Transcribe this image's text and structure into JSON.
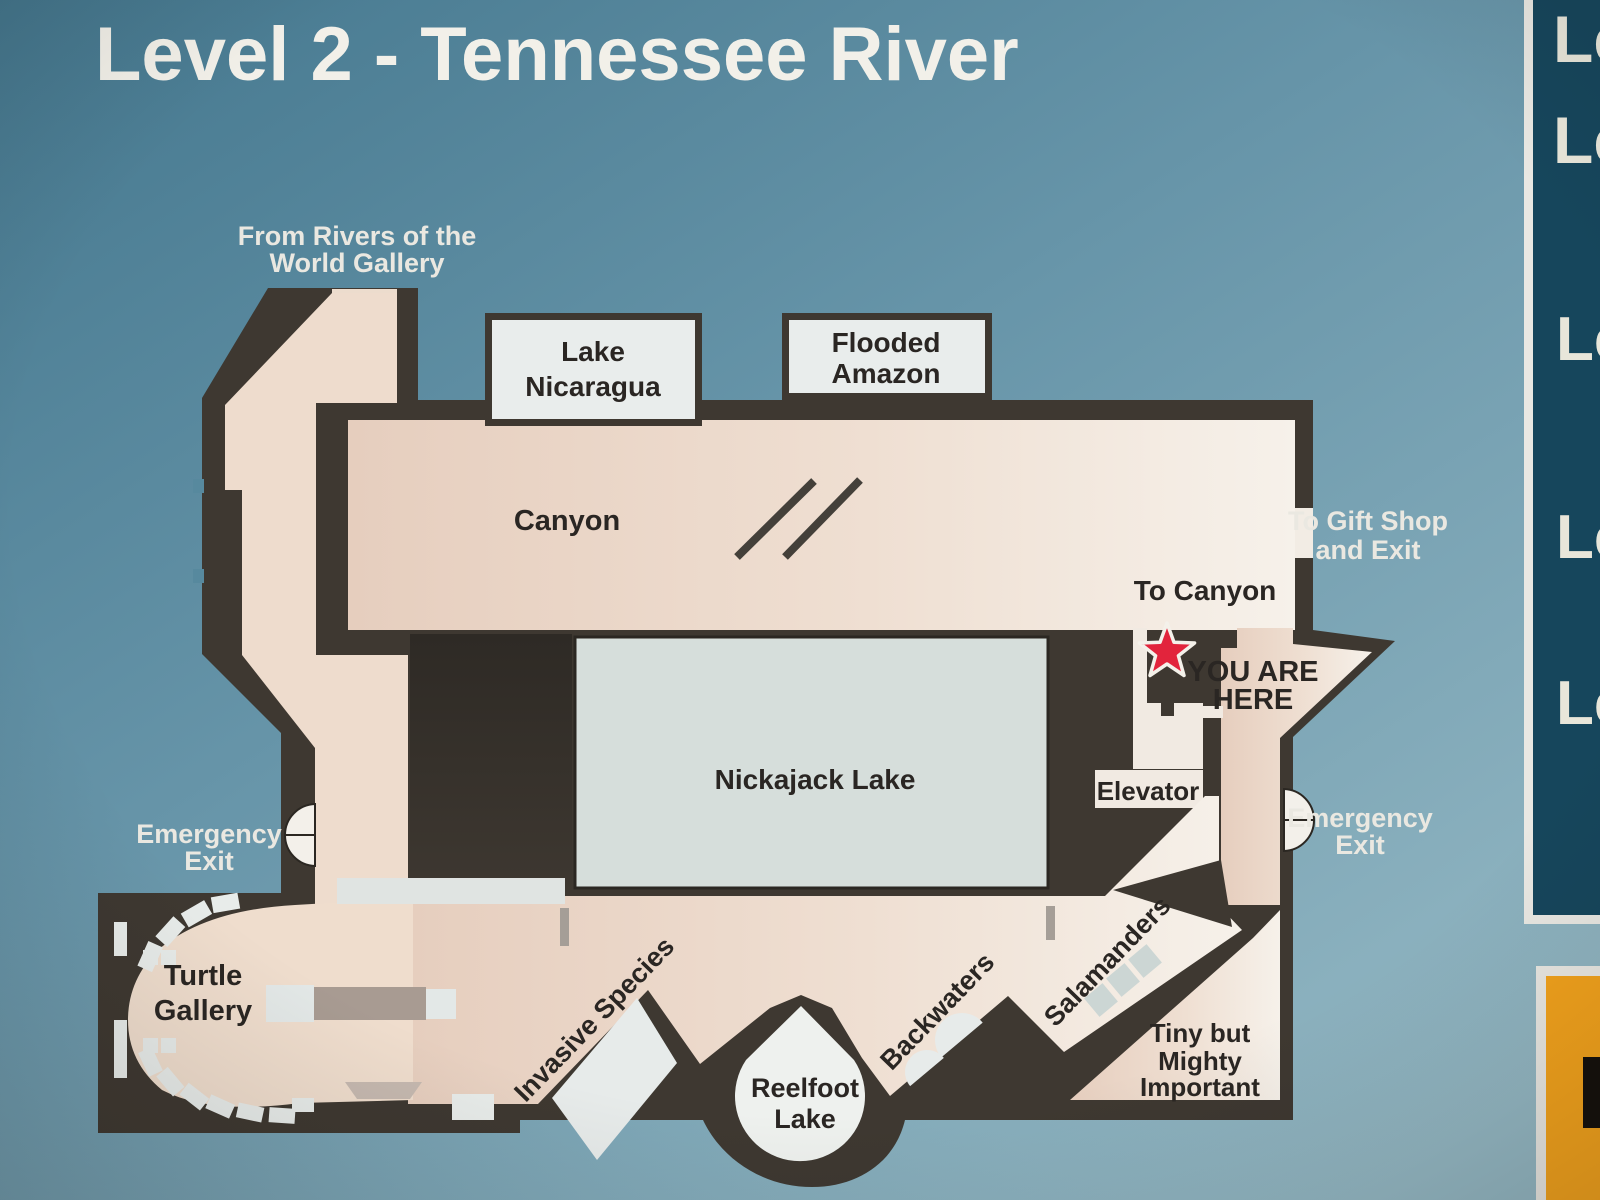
{
  "title": "Level 2 - Tennessee River",
  "legend_panel": {
    "items": [
      {
        "label": "Le"
      },
      {
        "label": "Le"
      },
      {
        "label": "Le"
      },
      {
        "label": "Le"
      },
      {
        "label": "Le"
      }
    ]
  },
  "labels": {
    "from_gallery": {
      "lines": [
        "From Rivers of the",
        "World Gallery"
      ]
    },
    "lake_nicaragua": {
      "lines": [
        "Lake",
        "Nicaragua"
      ]
    },
    "flooded_amazon": {
      "lines": [
        "Flooded",
        "Amazon"
      ]
    },
    "canyon": "Canyon",
    "to_gift_shop": {
      "lines": [
        "To Gift Shop",
        "and Exit"
      ]
    },
    "to_canyon": "To Canyon",
    "you_are_here": {
      "lines": [
        "YOU ARE",
        "HERE"
      ]
    },
    "elevator": "Elevator",
    "emergency_exit_left": {
      "lines": [
        "Emergency",
        "Exit"
      ]
    },
    "emergency_exit_right": {
      "lines": [
        "Emergency",
        "Exit"
      ]
    },
    "nickajack": "Nickajack Lake",
    "turtle_gallery": {
      "lines": [
        "Turtle",
        "Gallery"
      ]
    },
    "invasive_species": "Invasive Species",
    "reelfoot": {
      "lines": [
        "Reelfoot",
        "Lake"
      ]
    },
    "backwaters": "Backwaters",
    "salamanders": "Salamanders",
    "tiny_but_mighty": {
      "lines": [
        "Tiny but",
        "Mighty",
        "Important"
      ]
    }
  },
  "colors": {
    "background_blue": "#6795a9",
    "wall_dark": "#3e3831",
    "floor_cream": "#e9d3c3",
    "floor_light": "#f5efe8",
    "tank_box_fill": "#e9edec",
    "nickajack_fill": "#d6dedb",
    "legend_panel_navy": "#16465c",
    "legend_panel_border": "#e9e8e3",
    "orange_panel": "#f2a21c",
    "star_red": "#e2243c"
  }
}
